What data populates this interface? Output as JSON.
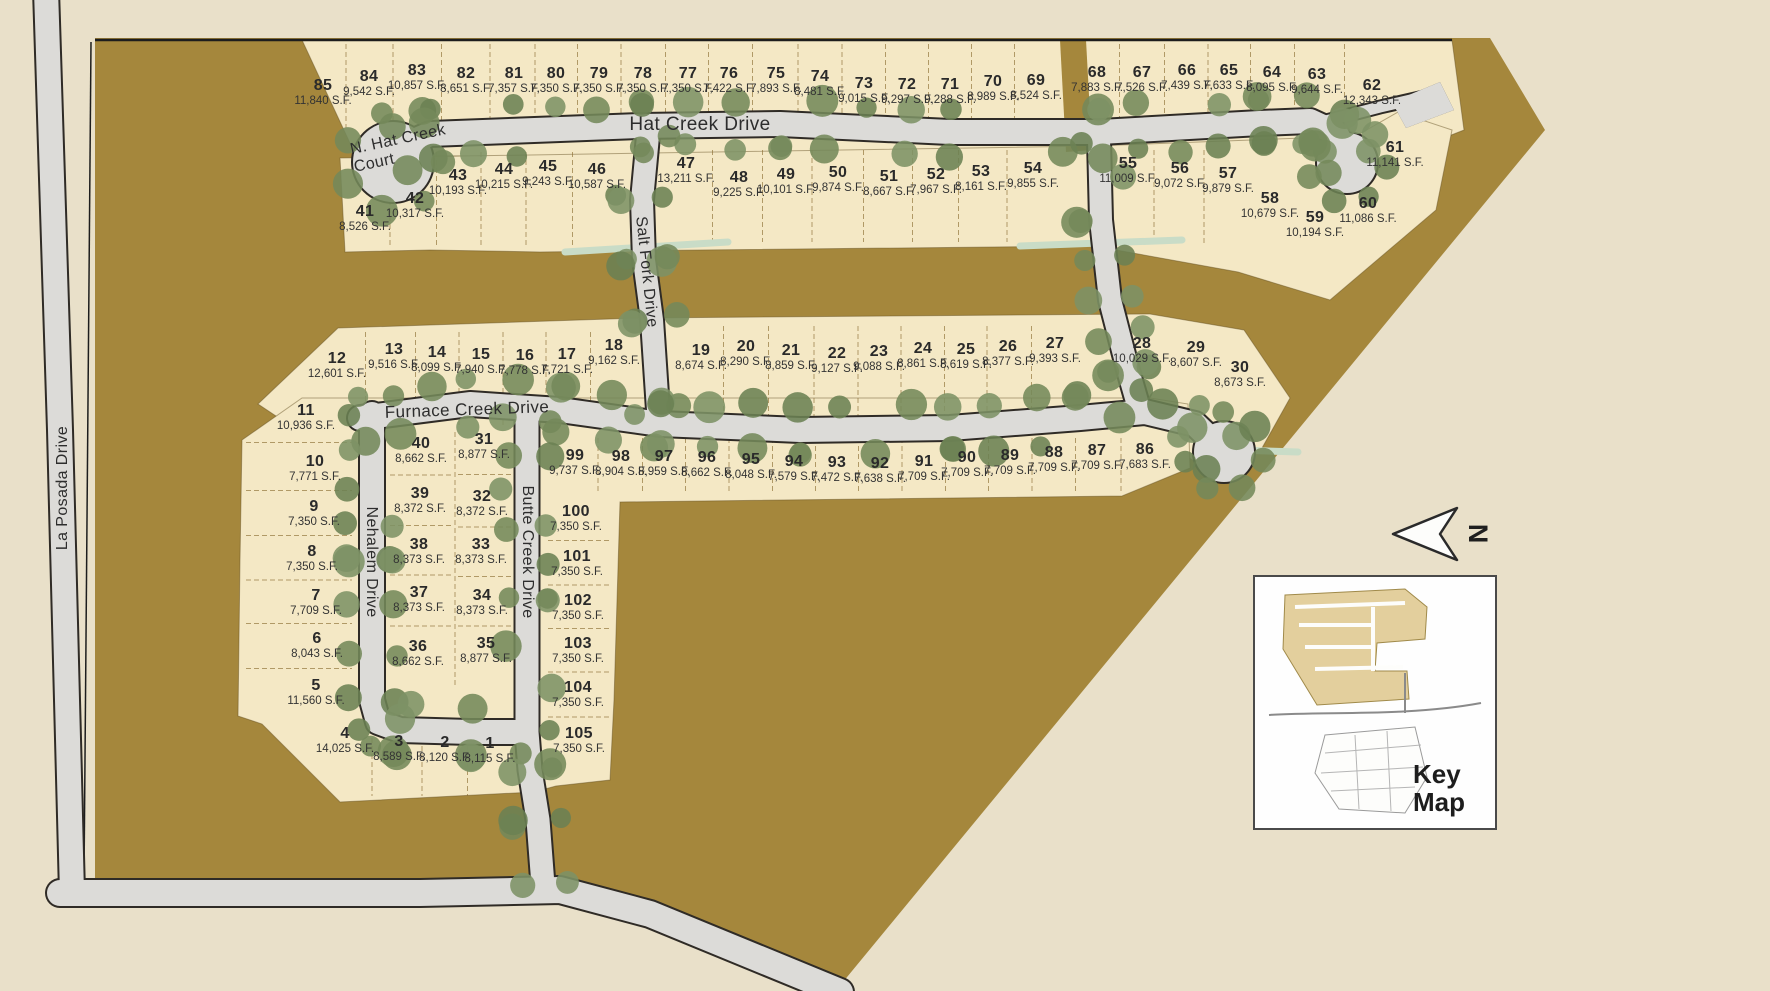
{
  "north_label": "N",
  "key_map": {
    "label": "Key Map"
  },
  "streets": [
    {
      "id": "la-posada",
      "name": "La Posada Drive"
    },
    {
      "id": "hat-creek",
      "name": "Hat Creek Drive"
    },
    {
      "id": "n-hat-creek",
      "name": "N. Hat Creek Court"
    },
    {
      "id": "salt-fork",
      "name": "Salt Fork Drive"
    },
    {
      "id": "furnace-creek",
      "name": "Furnace Creek Drive"
    },
    {
      "id": "nehalem",
      "name": "Nehalem Drive"
    },
    {
      "id": "butte-creek",
      "name": "Butte Creek Drive"
    }
  ],
  "lots": [
    {
      "num": "1",
      "sqft": "8,115 S.F.",
      "x": 490,
      "y": 750
    },
    {
      "num": "2",
      "sqft": "8,120 S.F.",
      "x": 445,
      "y": 749
    },
    {
      "num": "3",
      "sqft": "8,589 S.F.",
      "x": 399,
      "y": 748
    },
    {
      "num": "4",
      "sqft": "14,025 S.F.",
      "x": 345,
      "y": 740
    },
    {
      "num": "5",
      "sqft": "11,560 S.F.",
      "x": 316,
      "y": 692
    },
    {
      "num": "6",
      "sqft": "8,043 S.F.",
      "x": 317,
      "y": 645
    },
    {
      "num": "7",
      "sqft": "7,709 S.F.",
      "x": 316,
      "y": 602
    },
    {
      "num": "8",
      "sqft": "7,350 S.F.",
      "x": 312,
      "y": 558
    },
    {
      "num": "9",
      "sqft": "7,350 S.F.",
      "x": 314,
      "y": 513
    },
    {
      "num": "10",
      "sqft": "7,771 S.F.",
      "x": 315,
      "y": 468
    },
    {
      "num": "11",
      "sqft": "10,936 S.F.",
      "x": 306,
      "y": 417
    },
    {
      "num": "12",
      "sqft": "12,601 S.F.",
      "x": 337,
      "y": 365
    },
    {
      "num": "13",
      "sqft": "9,516 S.F.",
      "x": 394,
      "y": 356
    },
    {
      "num": "14",
      "sqft": "8,099 S.F.",
      "x": 437,
      "y": 359
    },
    {
      "num": "15",
      "sqft": "7,940 S.F.",
      "x": 481,
      "y": 361
    },
    {
      "num": "16",
      "sqft": "7,778 S.F.",
      "x": 525,
      "y": 362
    },
    {
      "num": "17",
      "sqft": "7,721 S.F.",
      "x": 567,
      "y": 361
    },
    {
      "num": "18",
      "sqft": "9,162 S.F.",
      "x": 614,
      "y": 352
    },
    {
      "num": "19",
      "sqft": "8,674 S.F.",
      "x": 701,
      "y": 357
    },
    {
      "num": "20",
      "sqft": "8,290 S.F.",
      "x": 746,
      "y": 353
    },
    {
      "num": "21",
      "sqft": "8,859 S.F.",
      "x": 791,
      "y": 357
    },
    {
      "num": "22",
      "sqft": "9,127 S.F.",
      "x": 837,
      "y": 360
    },
    {
      "num": "23",
      "sqft": "9,088 S.F.",
      "x": 879,
      "y": 358
    },
    {
      "num": "24",
      "sqft": "8,861 S.F.",
      "x": 923,
      "y": 355
    },
    {
      "num": "25",
      "sqft": "8,619 S.F.",
      "x": 966,
      "y": 356
    },
    {
      "num": "26",
      "sqft": "8,377 S.F.",
      "x": 1008,
      "y": 353
    },
    {
      "num": "27",
      "sqft": "9,393 S.F.",
      "x": 1055,
      "y": 350
    },
    {
      "num": "28",
      "sqft": "10,029 S.F.",
      "x": 1142,
      "y": 350
    },
    {
      "num": "29",
      "sqft": "8,607 S.F.",
      "x": 1196,
      "y": 354
    },
    {
      "num": "30",
      "sqft": "8,673 S.F.",
      "x": 1240,
      "y": 374
    },
    {
      "num": "31",
      "sqft": "8,877 S.F.",
      "x": 484,
      "y": 446
    },
    {
      "num": "32",
      "sqft": "8,372 S.F.",
      "x": 482,
      "y": 503
    },
    {
      "num": "33",
      "sqft": "8,373 S.F.",
      "x": 481,
      "y": 551
    },
    {
      "num": "34",
      "sqft": "8,373 S.F.",
      "x": 482,
      "y": 602
    },
    {
      "num": "35",
      "sqft": "8,877 S.F.",
      "x": 486,
      "y": 650
    },
    {
      "num": "36",
      "sqft": "8,662 S.F.",
      "x": 418,
      "y": 653
    },
    {
      "num": "37",
      "sqft": "8,373 S.F.",
      "x": 419,
      "y": 599
    },
    {
      "num": "38",
      "sqft": "8,373 S.F.",
      "x": 419,
      "y": 551
    },
    {
      "num": "39",
      "sqft": "8,372 S.F.",
      "x": 420,
      "y": 500
    },
    {
      "num": "40",
      "sqft": "8,662 S.F.",
      "x": 421,
      "y": 450
    },
    {
      "num": "41",
      "sqft": "8,526 S.F.",
      "x": 365,
      "y": 218
    },
    {
      "num": "42",
      "sqft": "10,317 S.F.",
      "x": 415,
      "y": 205
    },
    {
      "num": "43",
      "sqft": "10,193 S.F.",
      "x": 458,
      "y": 182
    },
    {
      "num": "44",
      "sqft": "10,215 S.F.",
      "x": 504,
      "y": 176
    },
    {
      "num": "45",
      "sqft": "9,243 S.F.",
      "x": 548,
      "y": 173
    },
    {
      "num": "46",
      "sqft": "10,587 S.F.",
      "x": 597,
      "y": 176
    },
    {
      "num": "47",
      "sqft": "13,211 S.F.",
      "x": 686,
      "y": 170
    },
    {
      "num": "48",
      "sqft": "9,225 S.F.",
      "x": 739,
      "y": 184
    },
    {
      "num": "49",
      "sqft": "10,101 S.F.",
      "x": 786,
      "y": 181
    },
    {
      "num": "50",
      "sqft": "9,874 S.F.",
      "x": 838,
      "y": 179
    },
    {
      "num": "51",
      "sqft": "8,667 S.F.",
      "x": 889,
      "y": 183
    },
    {
      "num": "52",
      "sqft": "7,967 S.F.",
      "x": 936,
      "y": 181
    },
    {
      "num": "53",
      "sqft": "8,161 S.F.",
      "x": 981,
      "y": 178
    },
    {
      "num": "54",
      "sqft": "9,855 S.F.",
      "x": 1033,
      "y": 175
    },
    {
      "num": "55",
      "sqft": "11,009 S.F.",
      "x": 1128,
      "y": 170
    },
    {
      "num": "56",
      "sqft": "9,072 S.F.",
      "x": 1180,
      "y": 175
    },
    {
      "num": "57",
      "sqft": "9,879 S.F.",
      "x": 1228,
      "y": 180
    },
    {
      "num": "58",
      "sqft": "10,679 S.F.",
      "x": 1270,
      "y": 205
    },
    {
      "num": "59",
      "sqft": "10,194 S.F.",
      "x": 1315,
      "y": 224
    },
    {
      "num": "60",
      "sqft": "11,086 S.F.",
      "x": 1368,
      "y": 210
    },
    {
      "num": "61",
      "sqft": "11,141 S.F.",
      "x": 1395,
      "y": 154
    },
    {
      "num": "62",
      "sqft": "12,343 S.F.",
      "x": 1372,
      "y": 92
    },
    {
      "num": "63",
      "sqft": "9,644 S.F.",
      "x": 1317,
      "y": 81
    },
    {
      "num": "64",
      "sqft": "8,095 S.F.",
      "x": 1272,
      "y": 79
    },
    {
      "num": "65",
      "sqft": "7,633 S.F.",
      "x": 1229,
      "y": 77
    },
    {
      "num": "66",
      "sqft": "7,439 S.F.",
      "x": 1187,
      "y": 77
    },
    {
      "num": "67",
      "sqft": "7,526 S.F.",
      "x": 1142,
      "y": 79
    },
    {
      "num": "68",
      "sqft": "7,883 S.F.",
      "x": 1097,
      "y": 79
    },
    {
      "num": "69",
      "sqft": "8,524 S.F.",
      "x": 1036,
      "y": 87
    },
    {
      "num": "70",
      "sqft": "8,989 S.F.",
      "x": 993,
      "y": 88
    },
    {
      "num": "71",
      "sqft": "9,288 S.F.",
      "x": 950,
      "y": 91
    },
    {
      "num": "72",
      "sqft": "9,297 S.F.",
      "x": 907,
      "y": 91
    },
    {
      "num": "73",
      "sqft": "9,015 S.F.",
      "x": 864,
      "y": 90
    },
    {
      "num": "74",
      "sqft": "8,481 S.F.",
      "x": 820,
      "y": 83
    },
    {
      "num": "75",
      "sqft": "7,893 S.F.",
      "x": 776,
      "y": 80
    },
    {
      "num": "76",
      "sqft": "7,422 S.F.",
      "x": 729,
      "y": 80
    },
    {
      "num": "77",
      "sqft": "7,350 S.F.",
      "x": 688,
      "y": 80
    },
    {
      "num": "78",
      "sqft": "7,350 S.F.",
      "x": 643,
      "y": 80
    },
    {
      "num": "79",
      "sqft": "7,350 S.F.",
      "x": 599,
      "y": 80
    },
    {
      "num": "80",
      "sqft": "7,350 S.F.",
      "x": 556,
      "y": 80
    },
    {
      "num": "81",
      "sqft": "7,357 S.F.",
      "x": 514,
      "y": 80
    },
    {
      "num": "82",
      "sqft": "8,651 S.F.",
      "x": 466,
      "y": 80
    },
    {
      "num": "83",
      "sqft": "10,857 S.F.",
      "x": 417,
      "y": 77
    },
    {
      "num": "84",
      "sqft": "9,542 S.F.",
      "x": 369,
      "y": 83
    },
    {
      "num": "85",
      "sqft": "11,840 S.F.",
      "x": 323,
      "y": 92
    },
    {
      "num": "86",
      "sqft": "7,683 S.F.",
      "x": 1145,
      "y": 456
    },
    {
      "num": "87",
      "sqft": "7,709 S.F.",
      "x": 1097,
      "y": 457
    },
    {
      "num": "88",
      "sqft": "7,709 S.F.",
      "x": 1054,
      "y": 459
    },
    {
      "num": "89",
      "sqft": "7,709 S.F.",
      "x": 1010,
      "y": 462
    },
    {
      "num": "90",
      "sqft": "7,709 S.F.",
      "x": 967,
      "y": 464
    },
    {
      "num": "91",
      "sqft": "7,709 S.F.",
      "x": 924,
      "y": 468
    },
    {
      "num": "92",
      "sqft": "7,638 S.F.",
      "x": 880,
      "y": 470
    },
    {
      "num": "93",
      "sqft": "7,472 S.F.",
      "x": 837,
      "y": 469
    },
    {
      "num": "94",
      "sqft": "7,579 S.F.",
      "x": 794,
      "y": 468
    },
    {
      "num": "95",
      "sqft": "8,048 S.F.",
      "x": 751,
      "y": 466
    },
    {
      "num": "96",
      "sqft": "8,662 S.F.",
      "x": 707,
      "y": 464
    },
    {
      "num": "97",
      "sqft": "8,959 S.F.",
      "x": 664,
      "y": 463
    },
    {
      "num": "98",
      "sqft": "8,904 S.F.",
      "x": 621,
      "y": 463
    },
    {
      "num": "99",
      "sqft": "9,737 S.F.",
      "x": 575,
      "y": 462
    },
    {
      "num": "100",
      "sqft": "7,350 S.F.",
      "x": 576,
      "y": 518
    },
    {
      "num": "101",
      "sqft": "7,350 S.F.",
      "x": 577,
      "y": 563
    },
    {
      "num": "102",
      "sqft": "7,350 S.F.",
      "x": 578,
      "y": 607
    },
    {
      "num": "103",
      "sqft": "7,350 S.F.",
      "x": 578,
      "y": 650
    },
    {
      "num": "104",
      "sqft": "7,350 S.F.",
      "x": 578,
      "y": 694
    },
    {
      "num": "105",
      "sqft": "7,350 S.F.",
      "x": 579,
      "y": 740
    }
  ]
}
